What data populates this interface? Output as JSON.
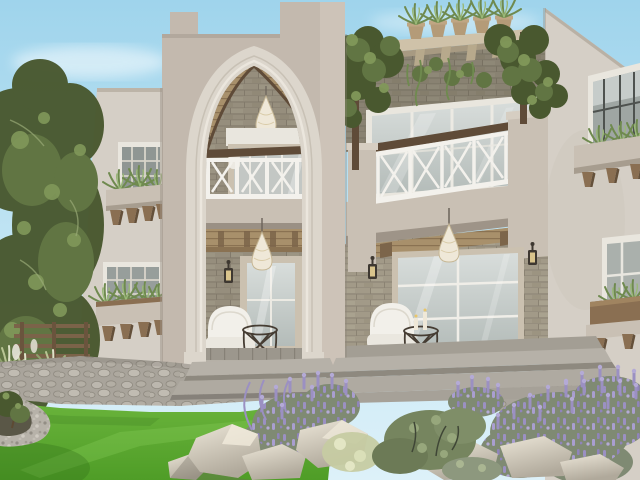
{
  "scene": {
    "title": "Villa exterior rendering",
    "image_type": "3d-architectural-visualization",
    "description": "Daytime rendering of a two-story Mediterranean-style villa: central tower with tall pointed entrance arch over stacked porches, vine-covered pergola balcony with white cross railings, stone-clad ground floor with glass patio doors, wicker pendant lamps, white garden armchairs with wire side tables, flanked by olive trees, a bright lawn, cobblestone paths, lavender bushes and light boulders in the foreground.",
    "time_of_day": "day",
    "elements": [
      "sky",
      "clouds",
      "olive-trees",
      "garden-fence",
      "ornamental-grasses",
      "left-wing",
      "left-upper-window",
      "left-lower-window",
      "central-tower",
      "entrance-arch",
      "arch-interior",
      "upper-balcony-railing",
      "arch-pendant-lamp",
      "upper-french-door",
      "upper-sconce",
      "lower-porch",
      "porch-pendant-lamp",
      "porch-sconce",
      "white-armchair",
      "wire-side-table",
      "glass-patio-door",
      "pergola",
      "pergola-planter-pots",
      "pergola-vines",
      "vine-balcony",
      "vine-balcony-railing",
      "balcony-glass-doors",
      "right-porch",
      "right-glass-door",
      "right-porch-sconces",
      "right-porch-pendant",
      "white-loveseat",
      "right-wire-table",
      "candle-holders",
      "right-wing",
      "right-upper-window",
      "right-lower-window",
      "window-planter-boxes",
      "corbels",
      "stone-steps",
      "cobblestone-path",
      "lawn",
      "gravel-border",
      "planting-bed",
      "lavender-bushes",
      "sage-shrubs",
      "boulders"
    ]
  },
  "palette": {
    "skyTop": "#9fd4ec",
    "skyHorizon": "#ddf1f9",
    "cloud": "#ffffff",
    "towerWall": "#c3b9ae",
    "towerSide": "#cdc3b8",
    "wingWall": "#d5cfc6",
    "archTrim": "#dcd6cc",
    "stucco": "#c9c0b4",
    "brick": "#a29a88",
    "brickJoint": "#8b8373",
    "wood": "#8a6f52",
    "woodDark": "#5f4b38",
    "woodCeiling": "#a8906b",
    "pergolaFascia": "#cfc2a9",
    "potClay": "#b49b78",
    "railWhite": "#f3f1ec",
    "frameWhite": "#e9e6de",
    "frameBeige": "#cbc1b0",
    "glass": "#c9cecb",
    "glassLight": "#dfe3e0",
    "porchFloor": "#9c978d",
    "stepStone": "#b6b1a8",
    "cobble": "#aca79e",
    "gravel": "#b7b2a9",
    "lawnLight": "#6db63e",
    "lawnDark": "#4f9d27",
    "treeDark": "#49582f",
    "treeMid": "#617543",
    "treeLight": "#81985a",
    "lavenderFoliage": "#7f8a73",
    "lavender": "#9b90c2",
    "lavenderLight": "#b4aad6",
    "rockLight": "#e9e3d5",
    "rockShade": "#b0a99b",
    "cream": "#efe8d8",
    "lantern": "#3e3831",
    "plantGreen": "#6f8a4f"
  }
}
